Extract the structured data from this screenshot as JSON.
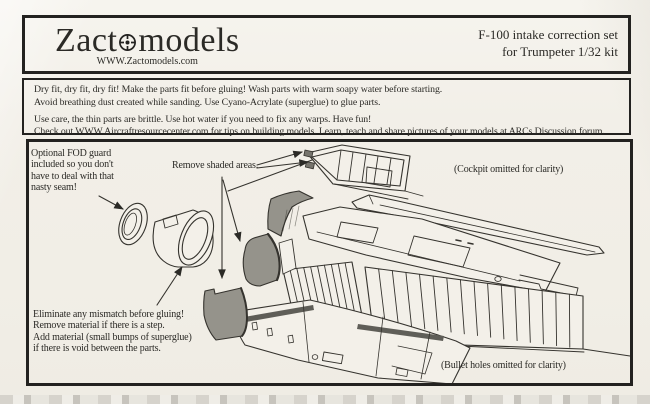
{
  "header": {
    "brand_pre": "Zact",
    "brand_post": "models",
    "website": "WWW.Zactomodels.com",
    "product_line1": "F-100 intake correction set",
    "product_line2": "for Trumpeter 1/32 kit"
  },
  "instructions": {
    "line1": "Dry fit, dry fit, dry fit! Make the parts fit before gluing! Wash parts with warm soapy water before starting.",
    "line2": "Avoid breathing dust created while sanding. Use Cyano-Acrylate (superglue) to glue parts.",
    "line3": "Use care, the thin parts are brittle. Use hot water if you need to fix any warps. Have fun!",
    "line4": "Check out WWW.Aircraftresourcecenter.com for tips on building models.  Learn, teach and share pictures of your models at ARCs Discussion forum."
  },
  "diagram": {
    "fod_note": {
      "l1": "Optional FOD guard",
      "l2": "included so you don't",
      "l3": "have to deal with that",
      "l4": "nasty seam!"
    },
    "remove_label": "Remove shaded areas.",
    "cockpit_note": "(Cockpit omitted for clarity)",
    "mismatch_note": {
      "l1": "Eliminate any mismatch before gluing!",
      "l2": "Remove material if there is a step.",
      "l3": "Add material (small bumps of superglue)",
      "l4": "if there is void between the parts."
    },
    "bullet_note": "(Bullet holes omitted for clarity)"
  },
  "icons": {
    "logo_reticle": "crosshair-reticle-icon"
  },
  "colors": {
    "paper": "#f2efe8",
    "ink": "#2b2a26",
    "shaded_part": "#95938b",
    "dark_stripe": "#5f5e58",
    "border": "#232220"
  }
}
